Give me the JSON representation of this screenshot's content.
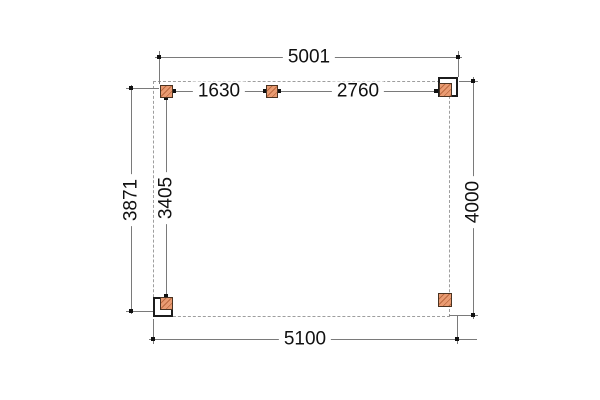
{
  "drawing_type": "plan-view dimension drawing",
  "dimensions": {
    "top_width": "5001",
    "span_left": "1630",
    "span_right": "2760",
    "left_outer_height": "3871",
    "left_inner_height": "3405",
    "right_height": "4000",
    "bottom_width": "5100"
  },
  "colors": {
    "background": "#ffffff",
    "line": "#7a7a7a",
    "dashed": "#9e9e9e",
    "tick": "#111111",
    "text": "#111111",
    "post_fill": "#e99b72",
    "post_hatch": "#bc6a41",
    "post_border": "#4a3322",
    "frame_stroke": "#1c1c1c"
  }
}
